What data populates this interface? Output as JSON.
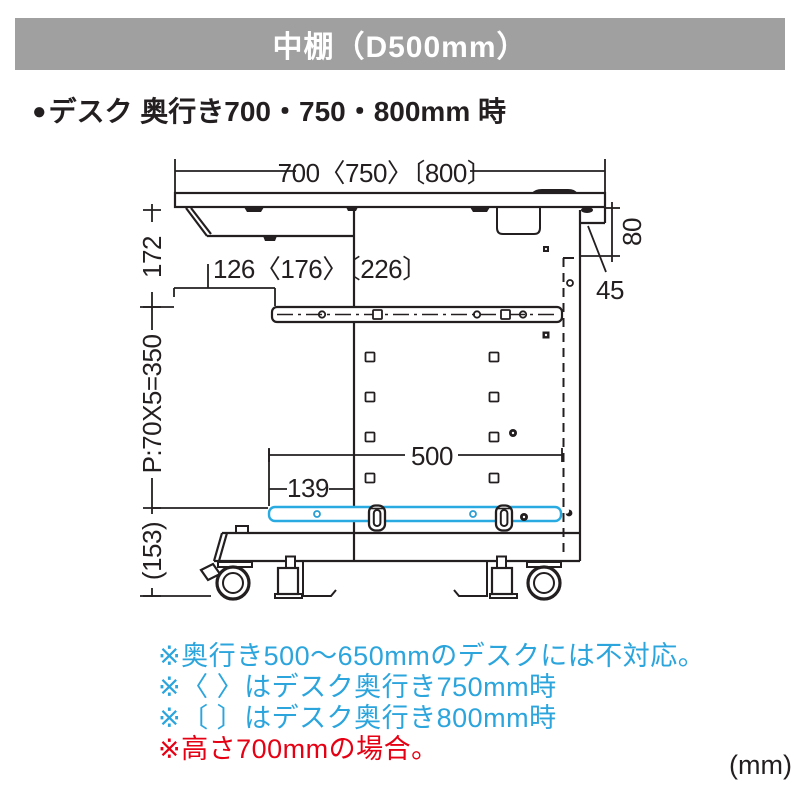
{
  "header": {
    "title": "中棚（D500mm）"
  },
  "section": {
    "bullet": "●",
    "title": "デスク 奥行き700・750・800mm 時"
  },
  "dims": {
    "top": "700〈750〉〔800〕",
    "drop172": "172",
    "tray": "126〈176〉〔226〕",
    "pitch": "P:70X5=350",
    "d80": "80",
    "d45": "45",
    "d500": "500",
    "d139": "139",
    "d153": "(153)"
  },
  "notes": [
    {
      "text": "※奥行き500〜650mmのデスクには不対応。",
      "color": "#2ca5dd"
    },
    {
      "text": "※〈 〉はデスク奥行き750mm時",
      "color": "#2ca5dd"
    },
    {
      "text": "※〔 〕はデスク奥行き800mm時",
      "color": "#2ca5dd"
    },
    {
      "text": "※高さ700mmの場合。",
      "color": "#e60013"
    }
  ],
  "unit": "(mm)",
  "colors": {
    "header_bg": "#a0a0a0",
    "line": "#231f20",
    "shelf_accent": "#29abe2",
    "note_blue": "#2ca5dd",
    "note_red": "#e60013"
  }
}
